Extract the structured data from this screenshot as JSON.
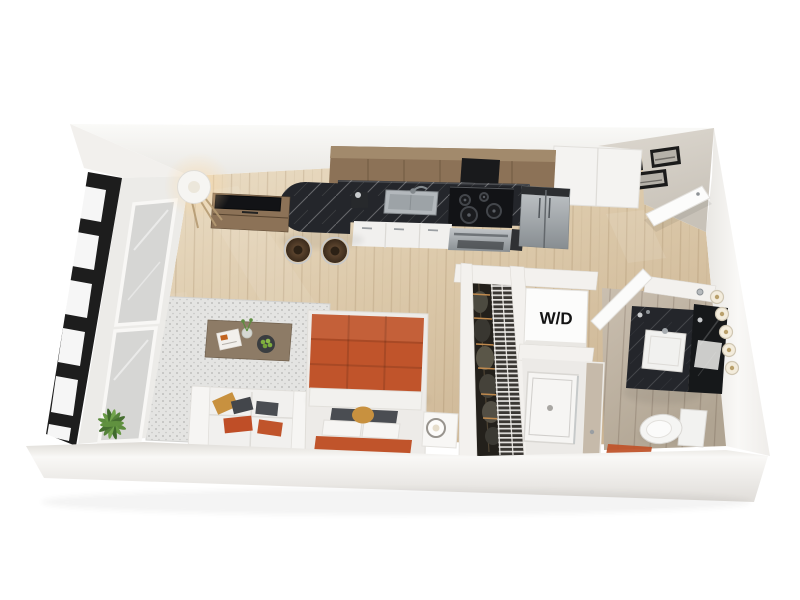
{
  "floorplan": {
    "wd_label": "W/D",
    "colors": {
      "wall": "#f3f1ee",
      "wall_shadow": "#dcd9d4",
      "floor_wood": "#d9c6a7",
      "floor_wood_light": "#ecdfc8",
      "floor_bath": "#bfb3a3",
      "counter_marble": "#24262b",
      "cabinet_wood": "#8c7257",
      "accent_orange": "#c0542b",
      "pillow_tan": "#c8913f",
      "pillow_gray": "#4a4d52",
      "rug": "#e4e4e2",
      "sofa": "#f1f0ee",
      "stainless": "#a7adb1",
      "window_frame": "#1d1d1d",
      "plant": "#5d8c3e",
      "closet": "#23201b",
      "bath_door": "#c6baaa",
      "art_frame": "#1b1b1b"
    }
  }
}
